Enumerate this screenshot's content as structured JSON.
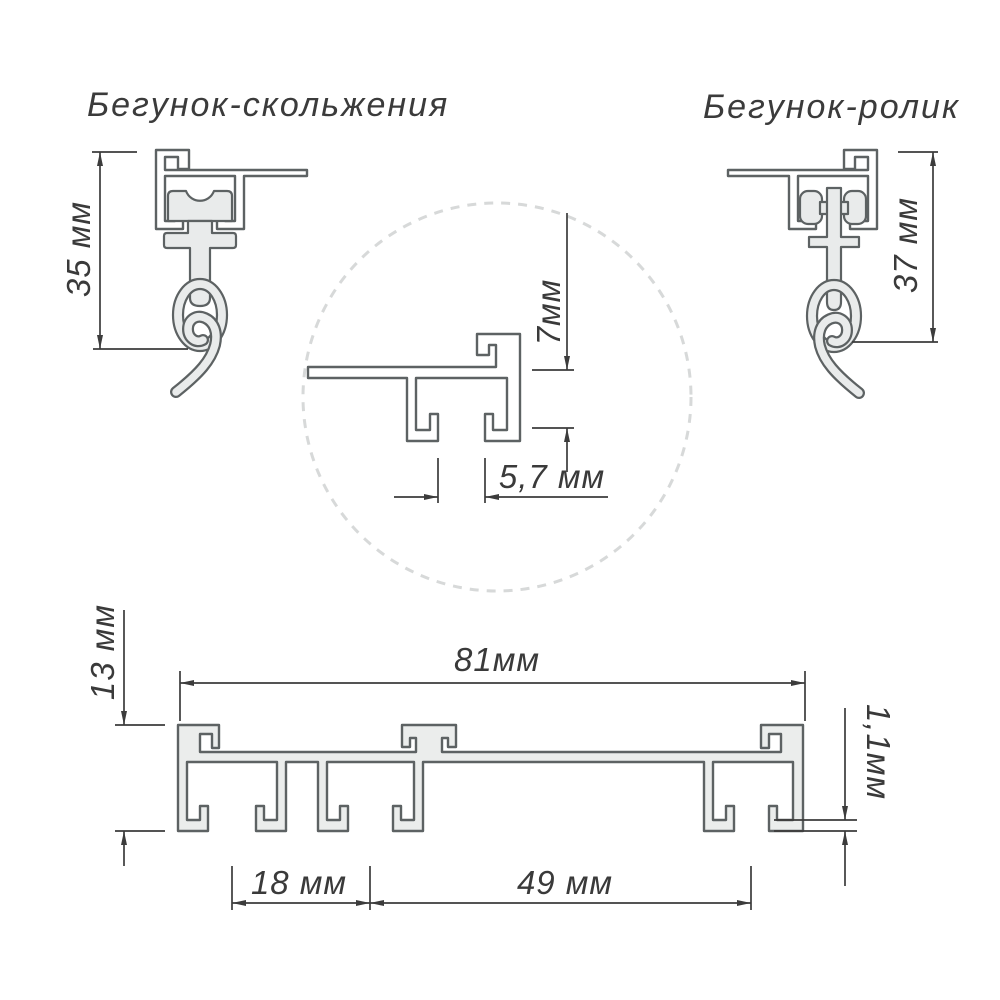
{
  "diagram": {
    "titles": {
      "slider": "Бегунок-скольжения",
      "roller": "Бегунок-ролик"
    },
    "dimensions": {
      "slider_height": "35 мм",
      "roller_height": "37 мм",
      "detail_depth": "7мм",
      "detail_slot": "5,7 мм",
      "profile_height": "13 мм",
      "profile_width": "81мм",
      "wall_thickness": "1,1мм",
      "track_pitch_small": "18 мм",
      "track_pitch_large": "49 мм"
    },
    "colors": {
      "background": "#ffffff",
      "outline": "#5d6263",
      "part_fill": "#e9ebeb",
      "dimension_lines": "#3c3c3c",
      "dashed_circle": "#d7d9d9",
      "text": "#3a3a3a"
    }
  }
}
